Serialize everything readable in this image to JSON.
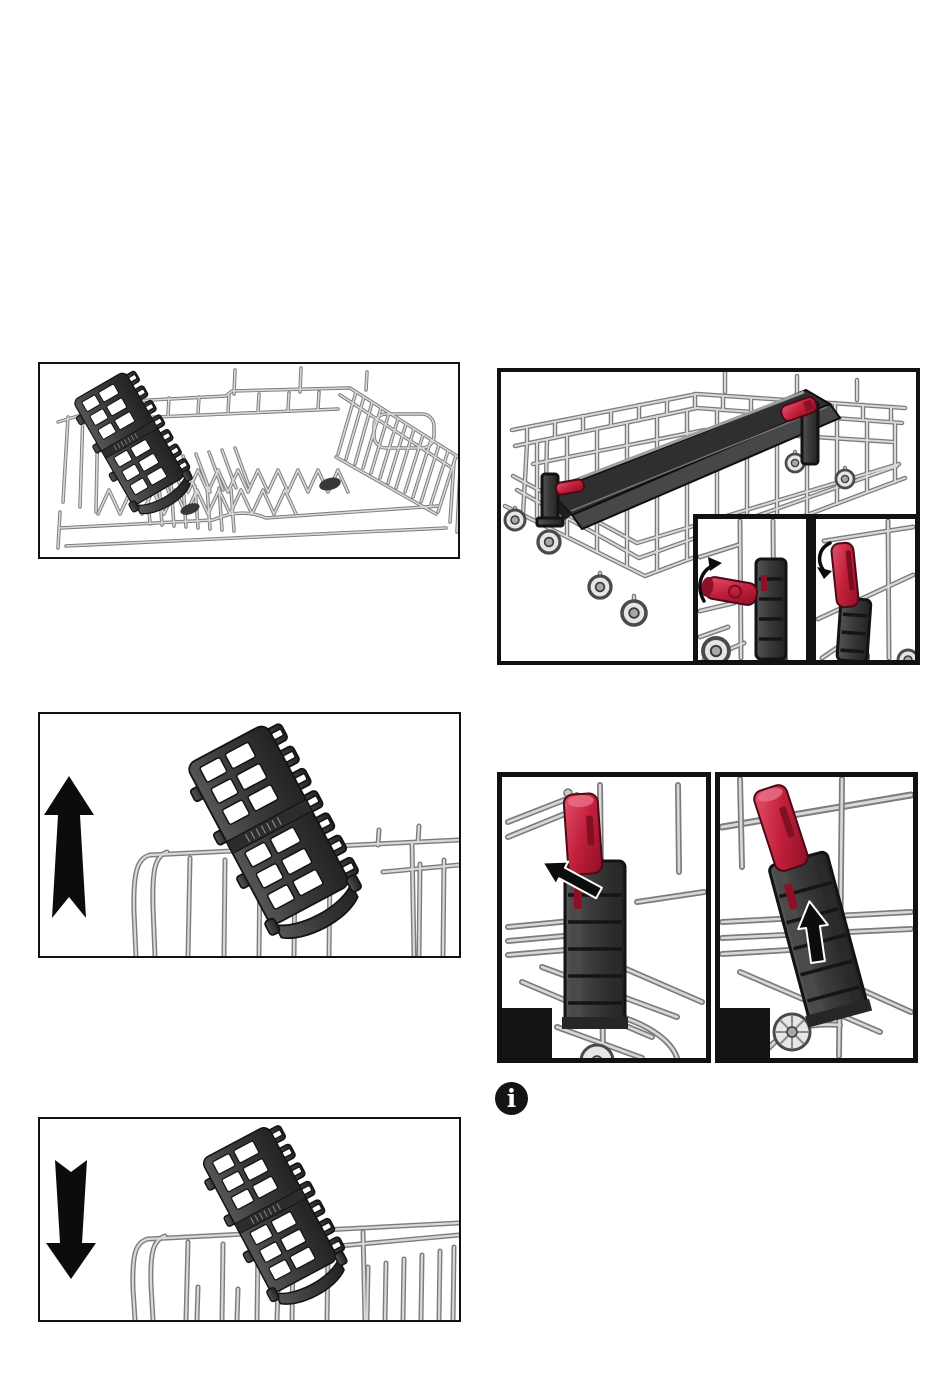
{
  "page": {
    "background": "#ffffff",
    "width": 950,
    "height": 1374
  },
  "colors": {
    "page_bg": "#ffffff",
    "frame": "#111111",
    "wire_dark": "#7c7c7c",
    "wire_light": "#d8d8d8",
    "plastic_outline": "#131313",
    "plastic_dark": "#3a3a3a",
    "accent_red": "#c21f3a",
    "accent_red_light": "#e4536d",
    "accent_red_dark": "#8e1026",
    "arrow_black": "#0c0c0c",
    "label_box": "#141414"
  },
  "info_note": {
    "icon_glyph": "i"
  },
  "figure_labels": {
    "left_step_box": "",
    "right_step_box": ""
  }
}
